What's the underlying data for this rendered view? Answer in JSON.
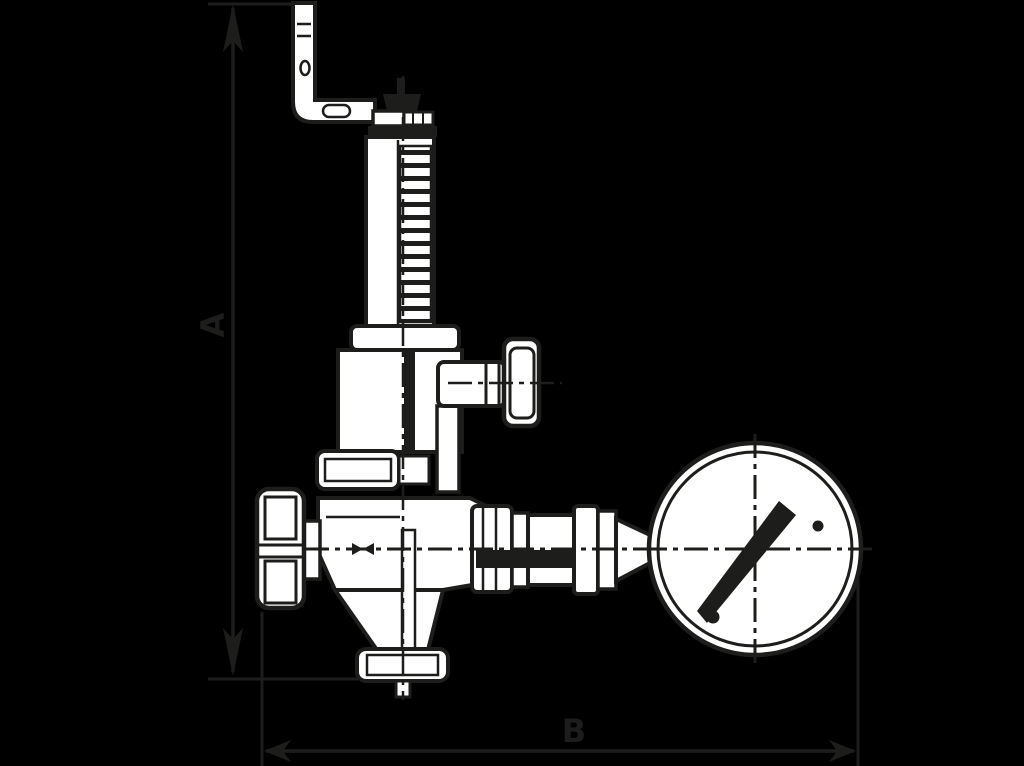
{
  "drawing": {
    "title": "angle-safety-valve-with-pressure-gauge-dimension-drawing",
    "labels": {
      "dim_a": "A",
      "dim_b": "B"
    },
    "colors": {
      "background": "#000000",
      "line": "#1d1d1b",
      "fill": "#ffffff"
    },
    "parts": [
      "mounting-bracket",
      "cap-nut",
      "threaded-spring-column",
      "spring-housing",
      "test-knob",
      "valve-body",
      "handwheel",
      "bottom-outlet-flange",
      "union-fittings",
      "pressure-gauge",
      "gauge-needle"
    ]
  }
}
